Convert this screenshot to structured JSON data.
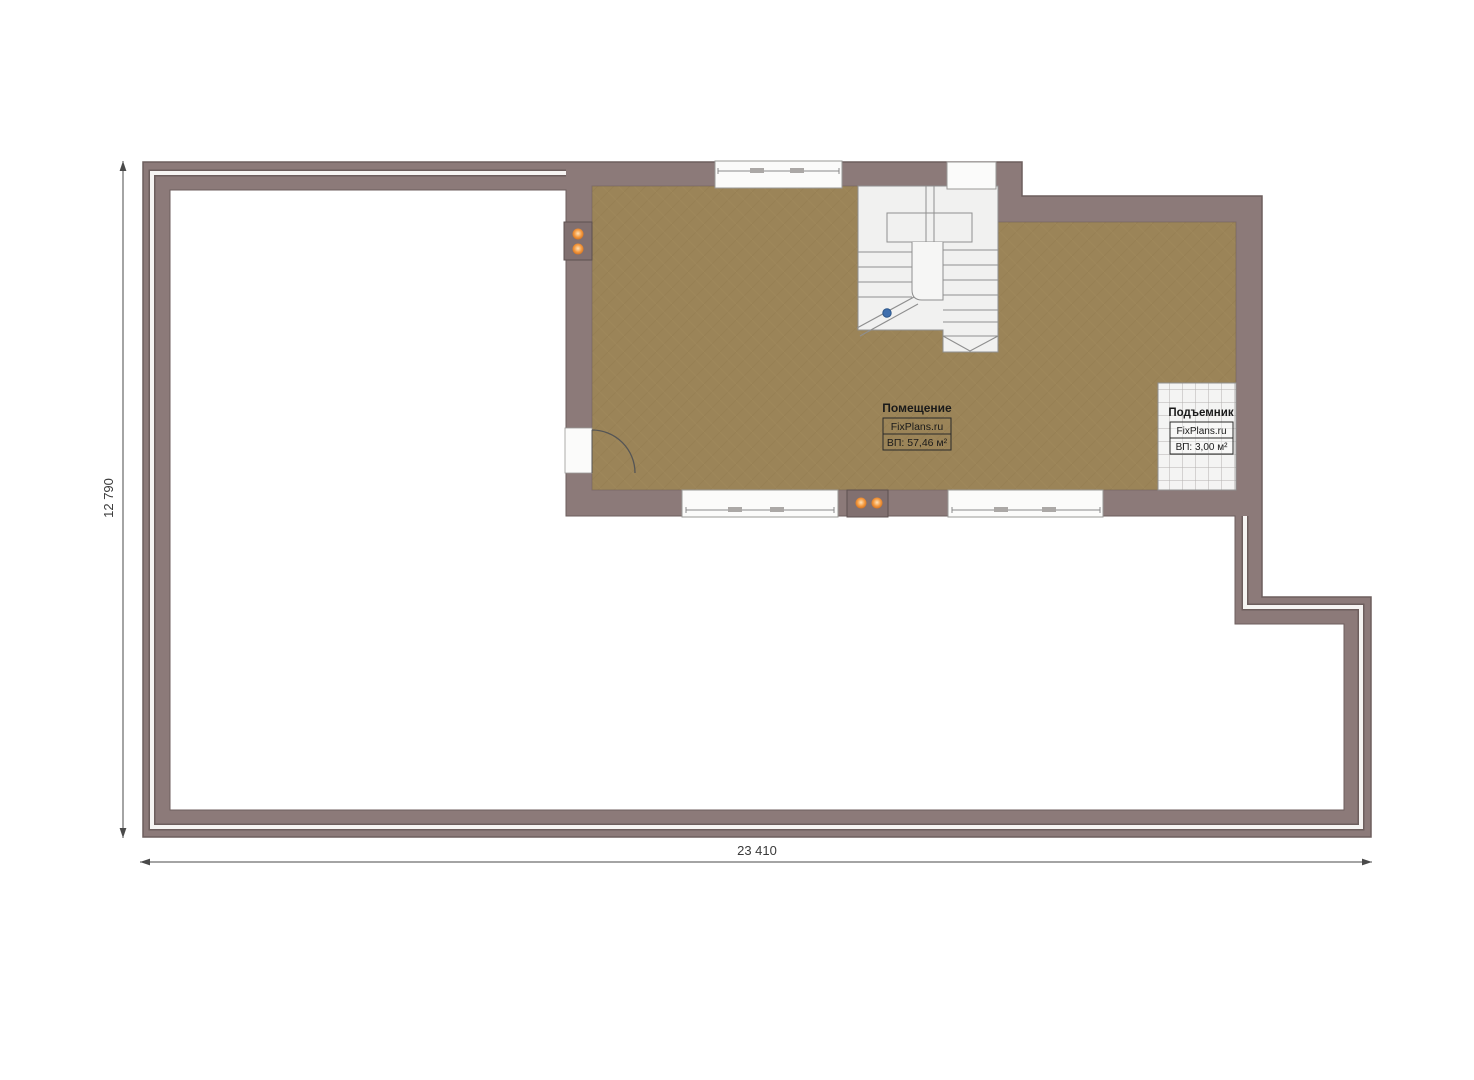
{
  "page": {
    "background": "#ffffff",
    "type": "floor-plan"
  },
  "room_label": {
    "title": "Помещение",
    "brand": "FixPlans.ru",
    "area": "ВП: 57,46 м²"
  },
  "lift_label": {
    "title": "Подъемник",
    "brand": "FixPlans.ru",
    "area": "ВП: 3,00 м²"
  },
  "dimensions": {
    "horizontal": "23 410",
    "vertical": "12 790"
  },
  "colors": {
    "wall": "#8c7a79",
    "wall_outline": "#6d5e5d",
    "wall_panel": "#817070",
    "floor_parquet": "#9b8458",
    "terrace_floor": "#ffffff",
    "parapet_stripe": "#f6f4f2",
    "stair_fill": "#f1f1f0",
    "stair_stroke": "#8f8f8f",
    "window_fill": "#fbfbfa",
    "tile_fill": "#f4f4f3",
    "tile_grid": "#b3b1af",
    "outlet_orange": "#ef8c35",
    "marker_blue": "#3f6fae",
    "dimension_line": "#4a4a4a"
  }
}
